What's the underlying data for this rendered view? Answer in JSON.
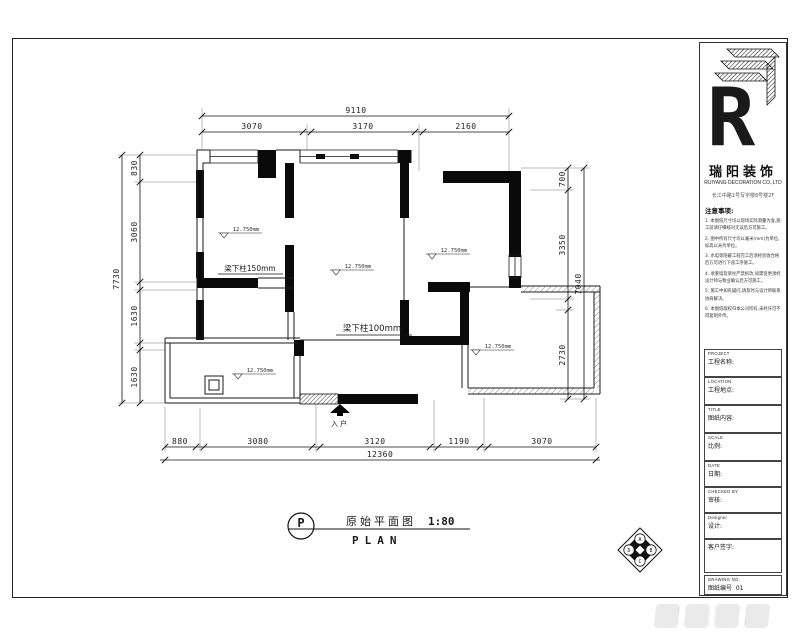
{
  "brand": {
    "logo_letter": "R",
    "name_cn": "瑞阳装饰",
    "name_en": "RUIYANG DECORATION CO.,LTD",
    "address": "长江中路1号写字楼8号楼2F"
  },
  "notes": {
    "heading": "注意事项:",
    "items": [
      "1. 本图纸尺寸均以现场实际测量为准,施工前请仔细核对无误后方可施工。",
      "2. 图中所有尺寸均以毫米(mm)为单位,标高以米为单位。",
      "3. 水电等隐蔽工程完工后须经验收合格后方可进行下道工序施工。",
      "4. 承重墙及梁柱严禁拆改,如需变更须经设计师与物业确认后方可施工。",
      "5. 施工中如有疑问,请及时与设计师联系协商解决。",
      "6. 本图纸版权归本公司所有,未经许可不得复制外传。"
    ]
  },
  "fields": [
    {
      "en": "PROJECT",
      "cn": "工程名称:"
    },
    {
      "en": "LOCATION",
      "cn": "工程地点:"
    },
    {
      "en": "TITLE",
      "cn": "图纸内容:"
    },
    {
      "en": "SCALE",
      "cn": "比例:"
    },
    {
      "en": "DATE",
      "cn": "日期:"
    },
    {
      "en": "CHECKED  BY",
      "cn": "审核:"
    },
    {
      "en": "Designer",
      "cn": "设计:"
    },
    {
      "en": "",
      "cn": "客户签字:"
    }
  ],
  "drawing_no": {
    "en": "DRAWING NO.",
    "cn": "图纸编号",
    "value": "01"
  },
  "plan": {
    "title_bubble": "P",
    "title_cn": "原始平面图",
    "title_scale": "1:80",
    "title_en": "PLAN",
    "entry_label": "入户",
    "beam_label_1": "梁下柱150mm",
    "beam_label_2": "梁下柱100mm",
    "elevation": "12.750mm",
    "index": {
      "top": "A",
      "right": "B",
      "bottom": "C",
      "left": "D"
    },
    "dims": {
      "top_overall": "9110",
      "top": [
        "3070",
        "3170",
        "2160"
      ],
      "bottom": [
        "880",
        "3080",
        "3120",
        "1190",
        "3070"
      ],
      "bottom_overall": "12360",
      "left": [
        "830",
        "3060",
        "1630",
        "1630"
      ],
      "left_overall": "7730",
      "right": [
        "700",
        "3350",
        "2730"
      ],
      "right_overall": "7040"
    }
  }
}
